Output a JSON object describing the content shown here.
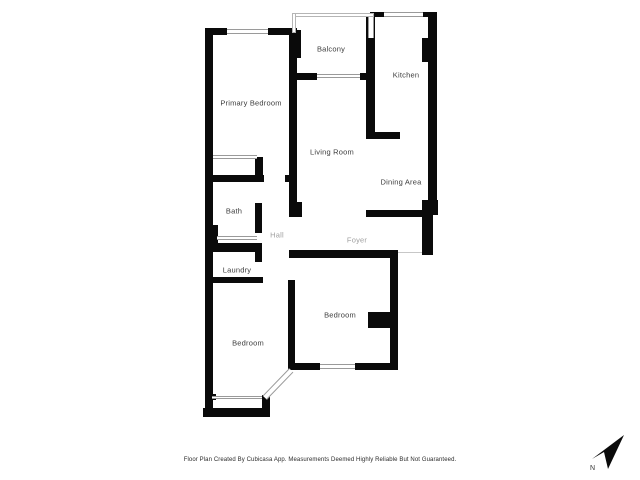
{
  "floor_plan": {
    "rooms": {
      "primary_bedroom": "Primary Bedroom",
      "balcony": "Balcony",
      "kitchen": "Kitchen",
      "living_room": "Living Room",
      "dining_area": "Dining Area",
      "bath": "Bath",
      "hall": "Hall",
      "foyer": "Foyer",
      "laundry": "Laundry",
      "bedroom_right": "Bedroom",
      "bedroom_left": "Bedroom"
    },
    "footer_text": "Floor Plan Created By Cubicasa App. Measurements Deemed Highly Reliable But Not Guaranteed.",
    "compass": {
      "north_label": "N"
    },
    "colors": {
      "wall": "#0a0a0a",
      "background": "#ffffff",
      "room_label": "#3d3d3d",
      "room_label_muted": "#a0a0a0",
      "window_line": "#9a9a9a"
    }
  }
}
